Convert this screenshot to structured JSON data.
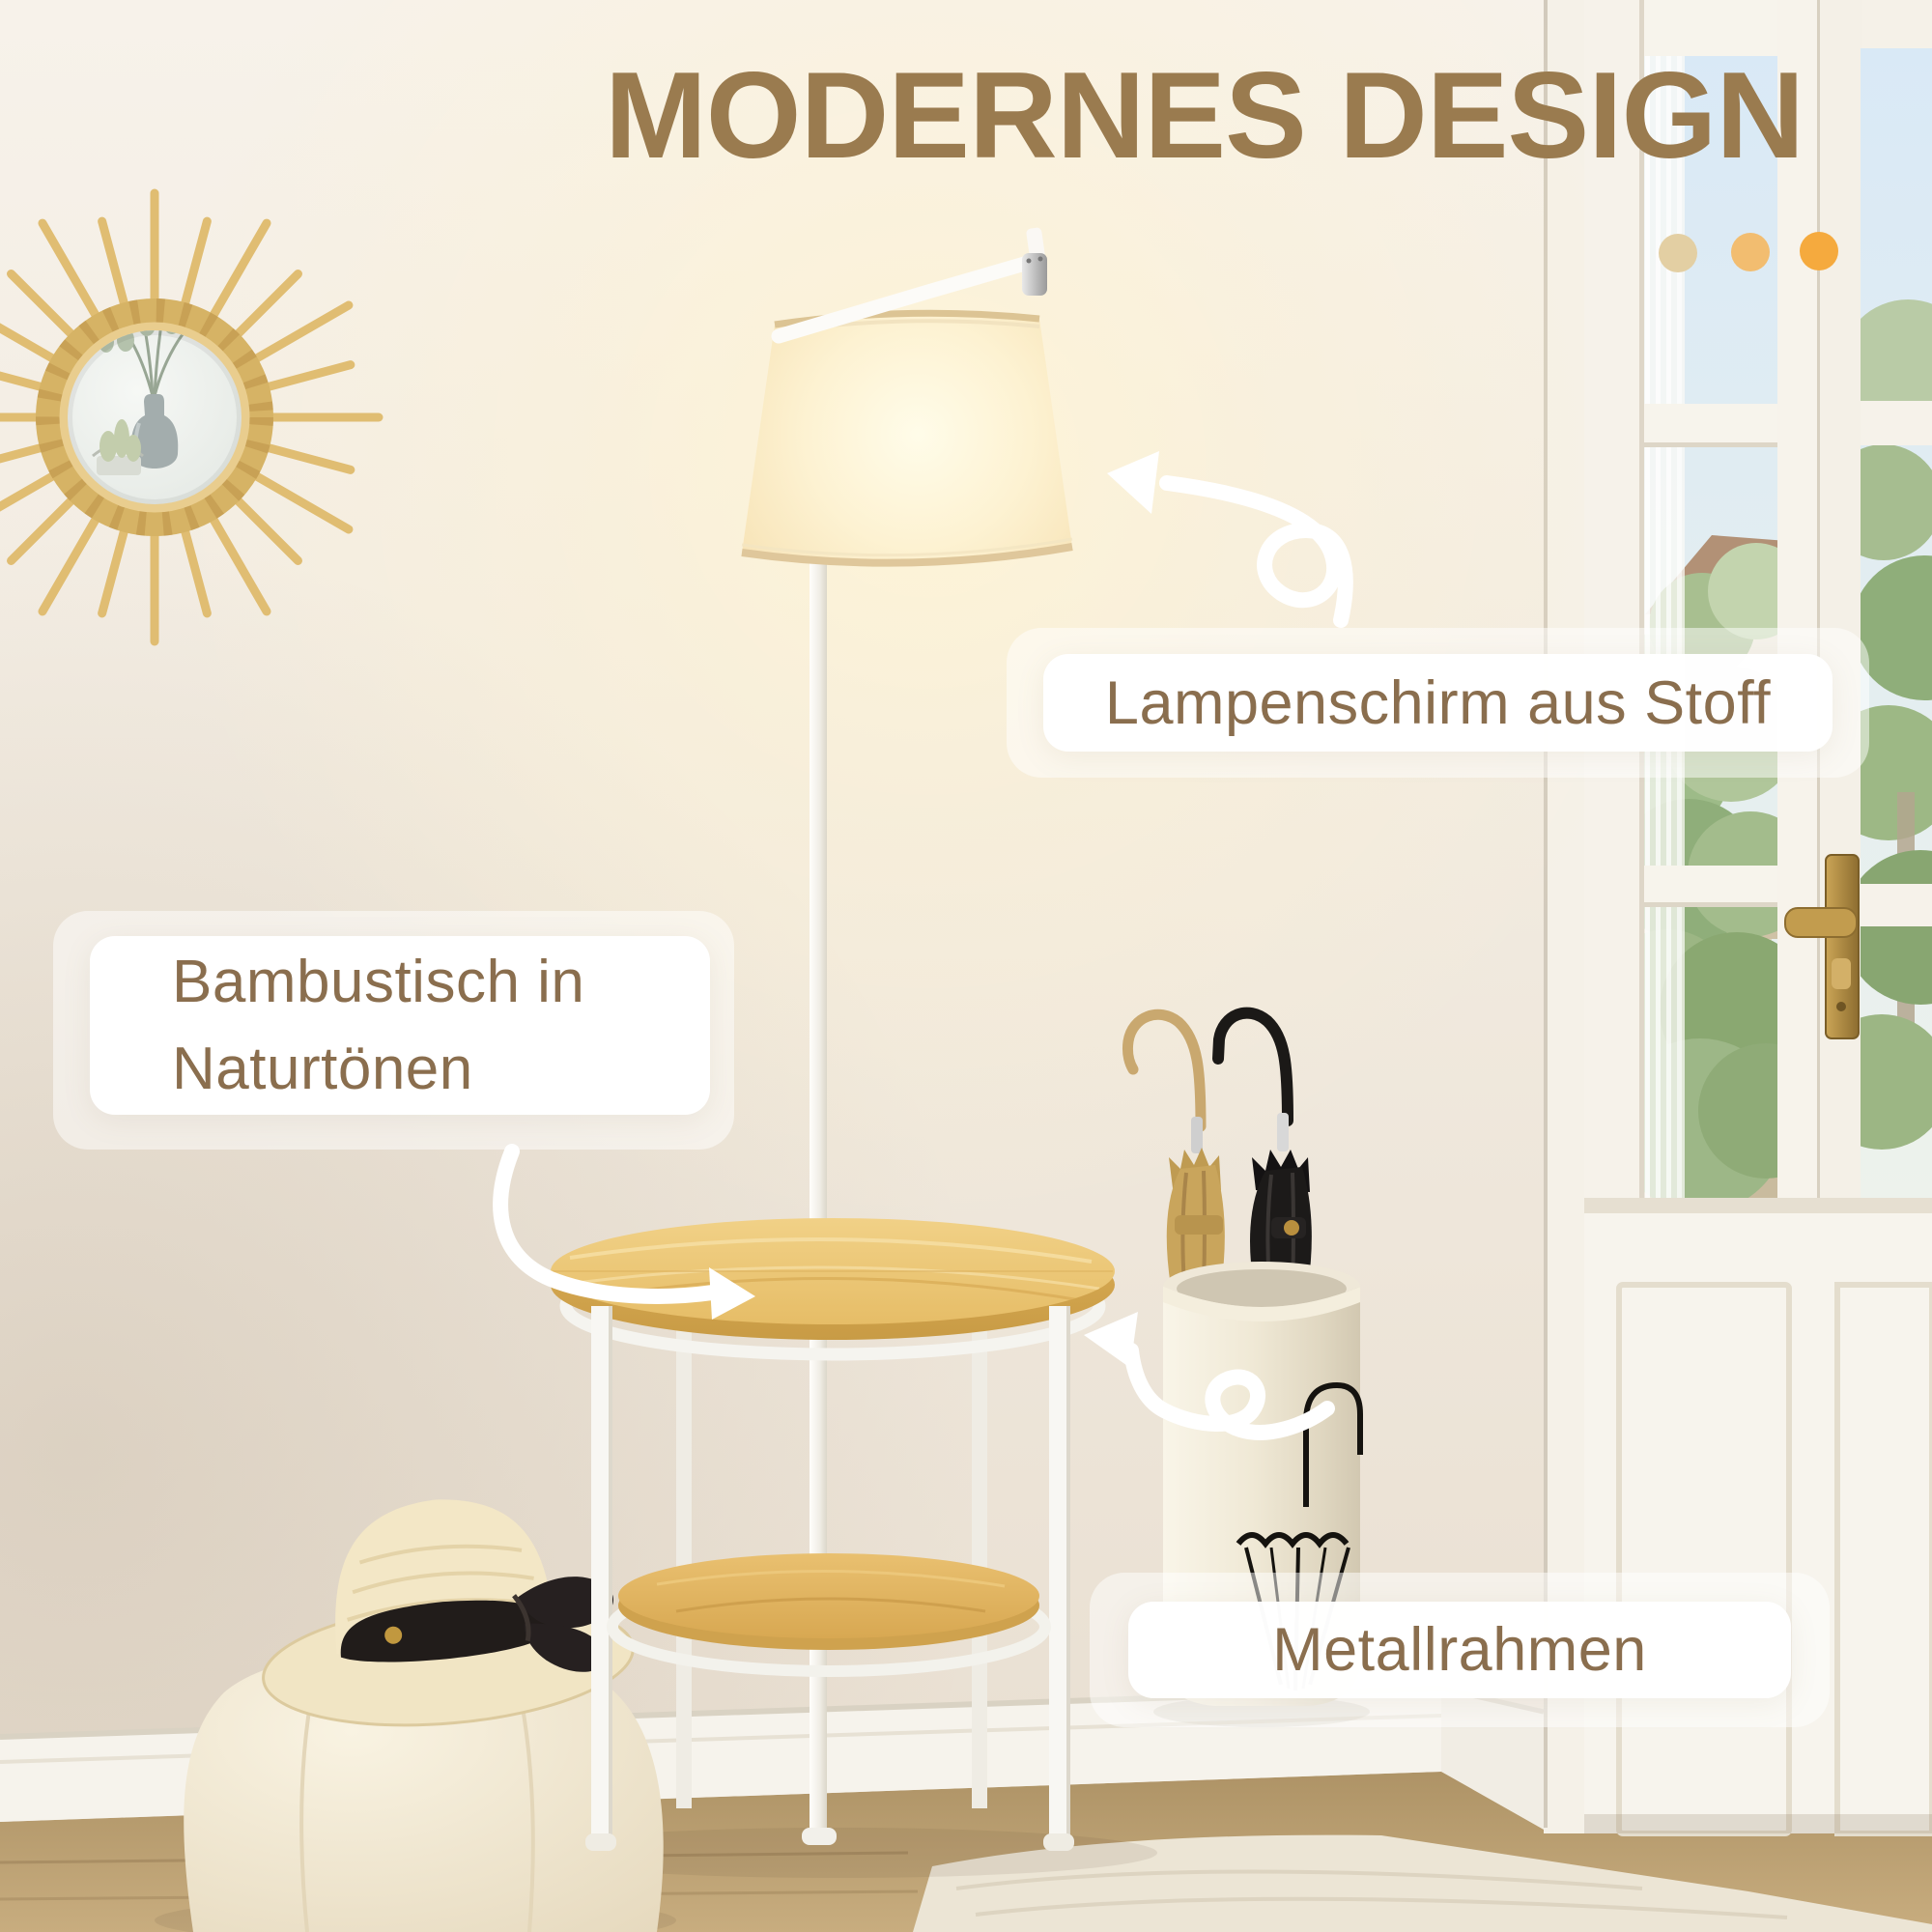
{
  "page": {
    "title": "MODERNES DESIGN"
  },
  "callouts": {
    "lampshade": {
      "text": "Lampenschirm aus Stoff"
    },
    "bamboo_table": {
      "line1": "Bambustisch in",
      "line2": "Naturtönen"
    },
    "metal_frame": {
      "text": "Metallrahmen"
    }
  },
  "decor": {
    "title_color": "#9a7b4f",
    "callout_text_color": "#8a6e4e",
    "dot_colors": [
      "#e3cfa3",
      "#f2bd70",
      "#f5aa3e"
    ],
    "accent_bamboo": "#e6bd67",
    "accent_lamp_glow": "#fdf2d2"
  },
  "icons": {
    "arrow_to_lampshade": "curly-arrow-up-left",
    "arrow_to_tabletop": "curved-arrow-right",
    "arrow_to_metal_frame": "curly-arrow-left"
  },
  "scene": {
    "objects": [
      "sunburst-rattan-mirror",
      "floor-lamp-with-fabric-shade",
      "bamboo-side-table",
      "metal-umbrella-stand",
      "tan-umbrella",
      "black-umbrella",
      "straw-hat",
      "pouf",
      "french-door-with-garden-view",
      "wood-floor",
      "cream-rug"
    ]
  }
}
